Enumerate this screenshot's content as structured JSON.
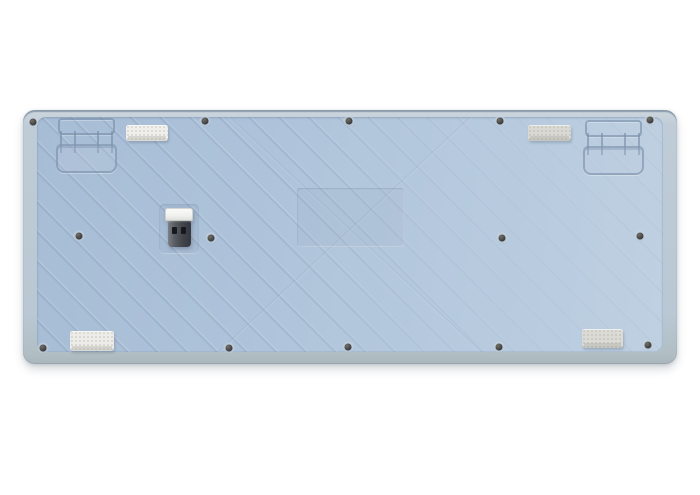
{
  "scene": {
    "type": "product-photo",
    "subject": "bottom view of a light blue wireless keyboard case",
    "background_color": "#ffffff"
  },
  "colors": {
    "case_rim": "#b9c7d3",
    "case_edge_top": "#7e92a3",
    "plate": "#aec3da",
    "groove": "rgba(118,140,166,0.6)",
    "screw": "#33373c",
    "dongle_cap": "#f0f1ef",
    "dongle_plug": "#43474d"
  },
  "components": {
    "flip_feet": [
      {
        "side": "left"
      },
      {
        "side": "right"
      }
    ],
    "rubber_pads": [
      {
        "position": "top-left",
        "x": 126,
        "y": 125,
        "w": 42,
        "h": 16,
        "color": "#f0efec"
      },
      {
        "position": "top-right",
        "x": 528,
        "y": 125,
        "w": 43,
        "h": 16,
        "color": "#d9d8d3"
      },
      {
        "position": "bottom-left",
        "x": 70,
        "y": 331,
        "w": 44,
        "h": 20,
        "color": "#edece8"
      },
      {
        "position": "bottom-right",
        "x": 582,
        "y": 329,
        "w": 41,
        "h": 19,
        "color": "#dbdad5"
      }
    ],
    "screws": [
      {
        "x": 33,
        "y": 122
      },
      {
        "x": 205,
        "y": 121
      },
      {
        "x": 349,
        "y": 121
      },
      {
        "x": 500,
        "y": 121
      },
      {
        "x": 650,
        "y": 120
      },
      {
        "x": 79,
        "y": 236
      },
      {
        "x": 211,
        "y": 238
      },
      {
        "x": 502,
        "y": 238
      },
      {
        "x": 640,
        "y": 236
      },
      {
        "x": 43,
        "y": 348
      },
      {
        "x": 229,
        "y": 348
      },
      {
        "x": 348,
        "y": 347
      },
      {
        "x": 499,
        "y": 347
      },
      {
        "x": 648,
        "y": 345
      }
    ],
    "usb_dongle": {
      "present": true,
      "stored_in_slot": true
    },
    "label_recess": {
      "present": true
    }
  }
}
